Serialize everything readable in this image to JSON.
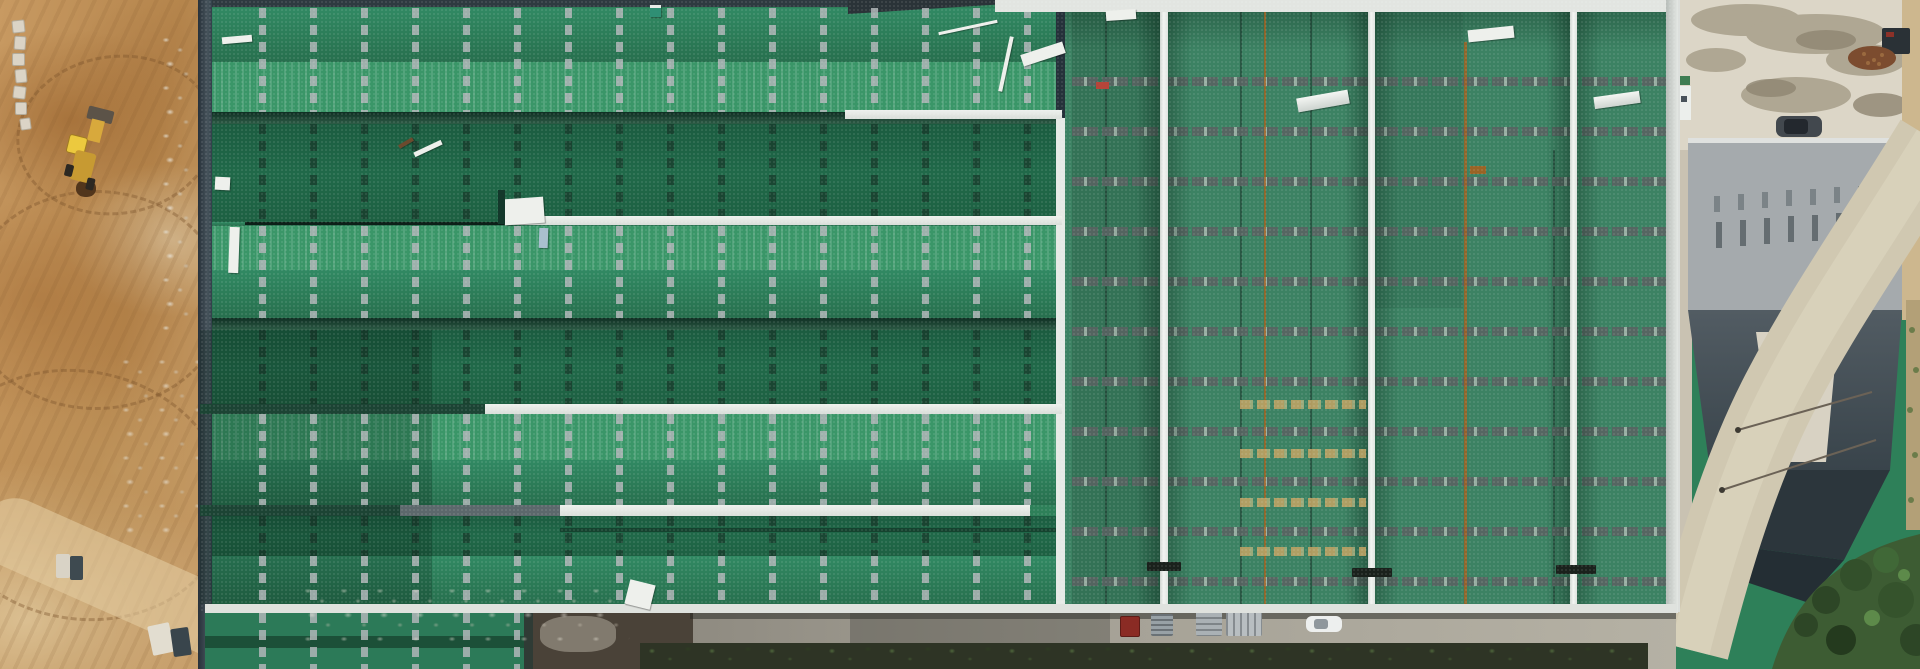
{
  "scene": {
    "type": "aerial-drone-photograph",
    "setting": "Top-down drone view of a large industrial warehouse with a green metal roof under construction; excavated bare earth on the left, concrete apron with a gray-roofed annex building and curved access road on the right, service road with parked vehicles along the bottom",
    "regions": {
      "left_strip": "excavated orange-brown earth with tire-track arcs, stone blocks, rubble and a yellow wheel loader",
      "main_roof_left": "green roof bays running horizontally with gray skylight dash strips, dark ridge bands and white walkway strips",
      "main_roof_right": "green roof panels running vertically with white ridge caps, rust seam lines and horizontal skylight dashes",
      "far_right": "concrete apron with damp stains, parked dark car, gray and slate annex roof, curving tan road, shrubs",
      "bottom": "service road with red truck, pallet stacks, white car and a dark vegetation ditch"
    },
    "objects": [
      {
        "name": "wheel-loader",
        "color": "#ecc93e"
      },
      {
        "name": "excavation-pit",
        "color": "#52361c"
      },
      {
        "name": "stone-blocks",
        "color": "#dbd4c6"
      },
      {
        "name": "concrete-cubes",
        "color": "#d9d3c6"
      },
      {
        "name": "skylight-strips",
        "color": "#9aa0a4"
      },
      {
        "name": "walkway-strips",
        "color": "#eef1ed"
      },
      {
        "name": "ridge-caps",
        "color": "#f2f4f1"
      },
      {
        "name": "rust-seams",
        "color": "#a3601f"
      },
      {
        "name": "debris-planks",
        "color": "#eef0ec"
      },
      {
        "name": "roof-platform",
        "color": "#eef0ec"
      },
      {
        "name": "red-truck",
        "color": "#8a2b24"
      },
      {
        "name": "pallet-stacks",
        "color": "#aab1b5"
      },
      {
        "name": "white-car",
        "color": "#edefee"
      },
      {
        "name": "dark-car",
        "color": "#42484e"
      },
      {
        "name": "gray-annex-roof",
        "color": "#a5aaad"
      },
      {
        "name": "slate-roof",
        "color": "#4d575e"
      },
      {
        "name": "curved-road",
        "color": "#d0c8b1"
      },
      {
        "name": "shrubs",
        "color": "#3d5c33"
      },
      {
        "name": "debris-pile",
        "color": "#7c4c2f"
      }
    ],
    "palette": {
      "roof_green_mid": "#2e8059",
      "roof_green_light": "#3a9668",
      "roof_green_dark": "#1e6345",
      "ridge_band_dark": "#14382b",
      "right_section_green": "#3c8263",
      "dirt_base": "#c89a62",
      "dirt_dark": "#a06c34",
      "dirt_pale": "#e0d0a8",
      "concrete": "#dcd6c7",
      "road_gray": "#a5a196",
      "ditch_green": "#2e3425"
    }
  }
}
